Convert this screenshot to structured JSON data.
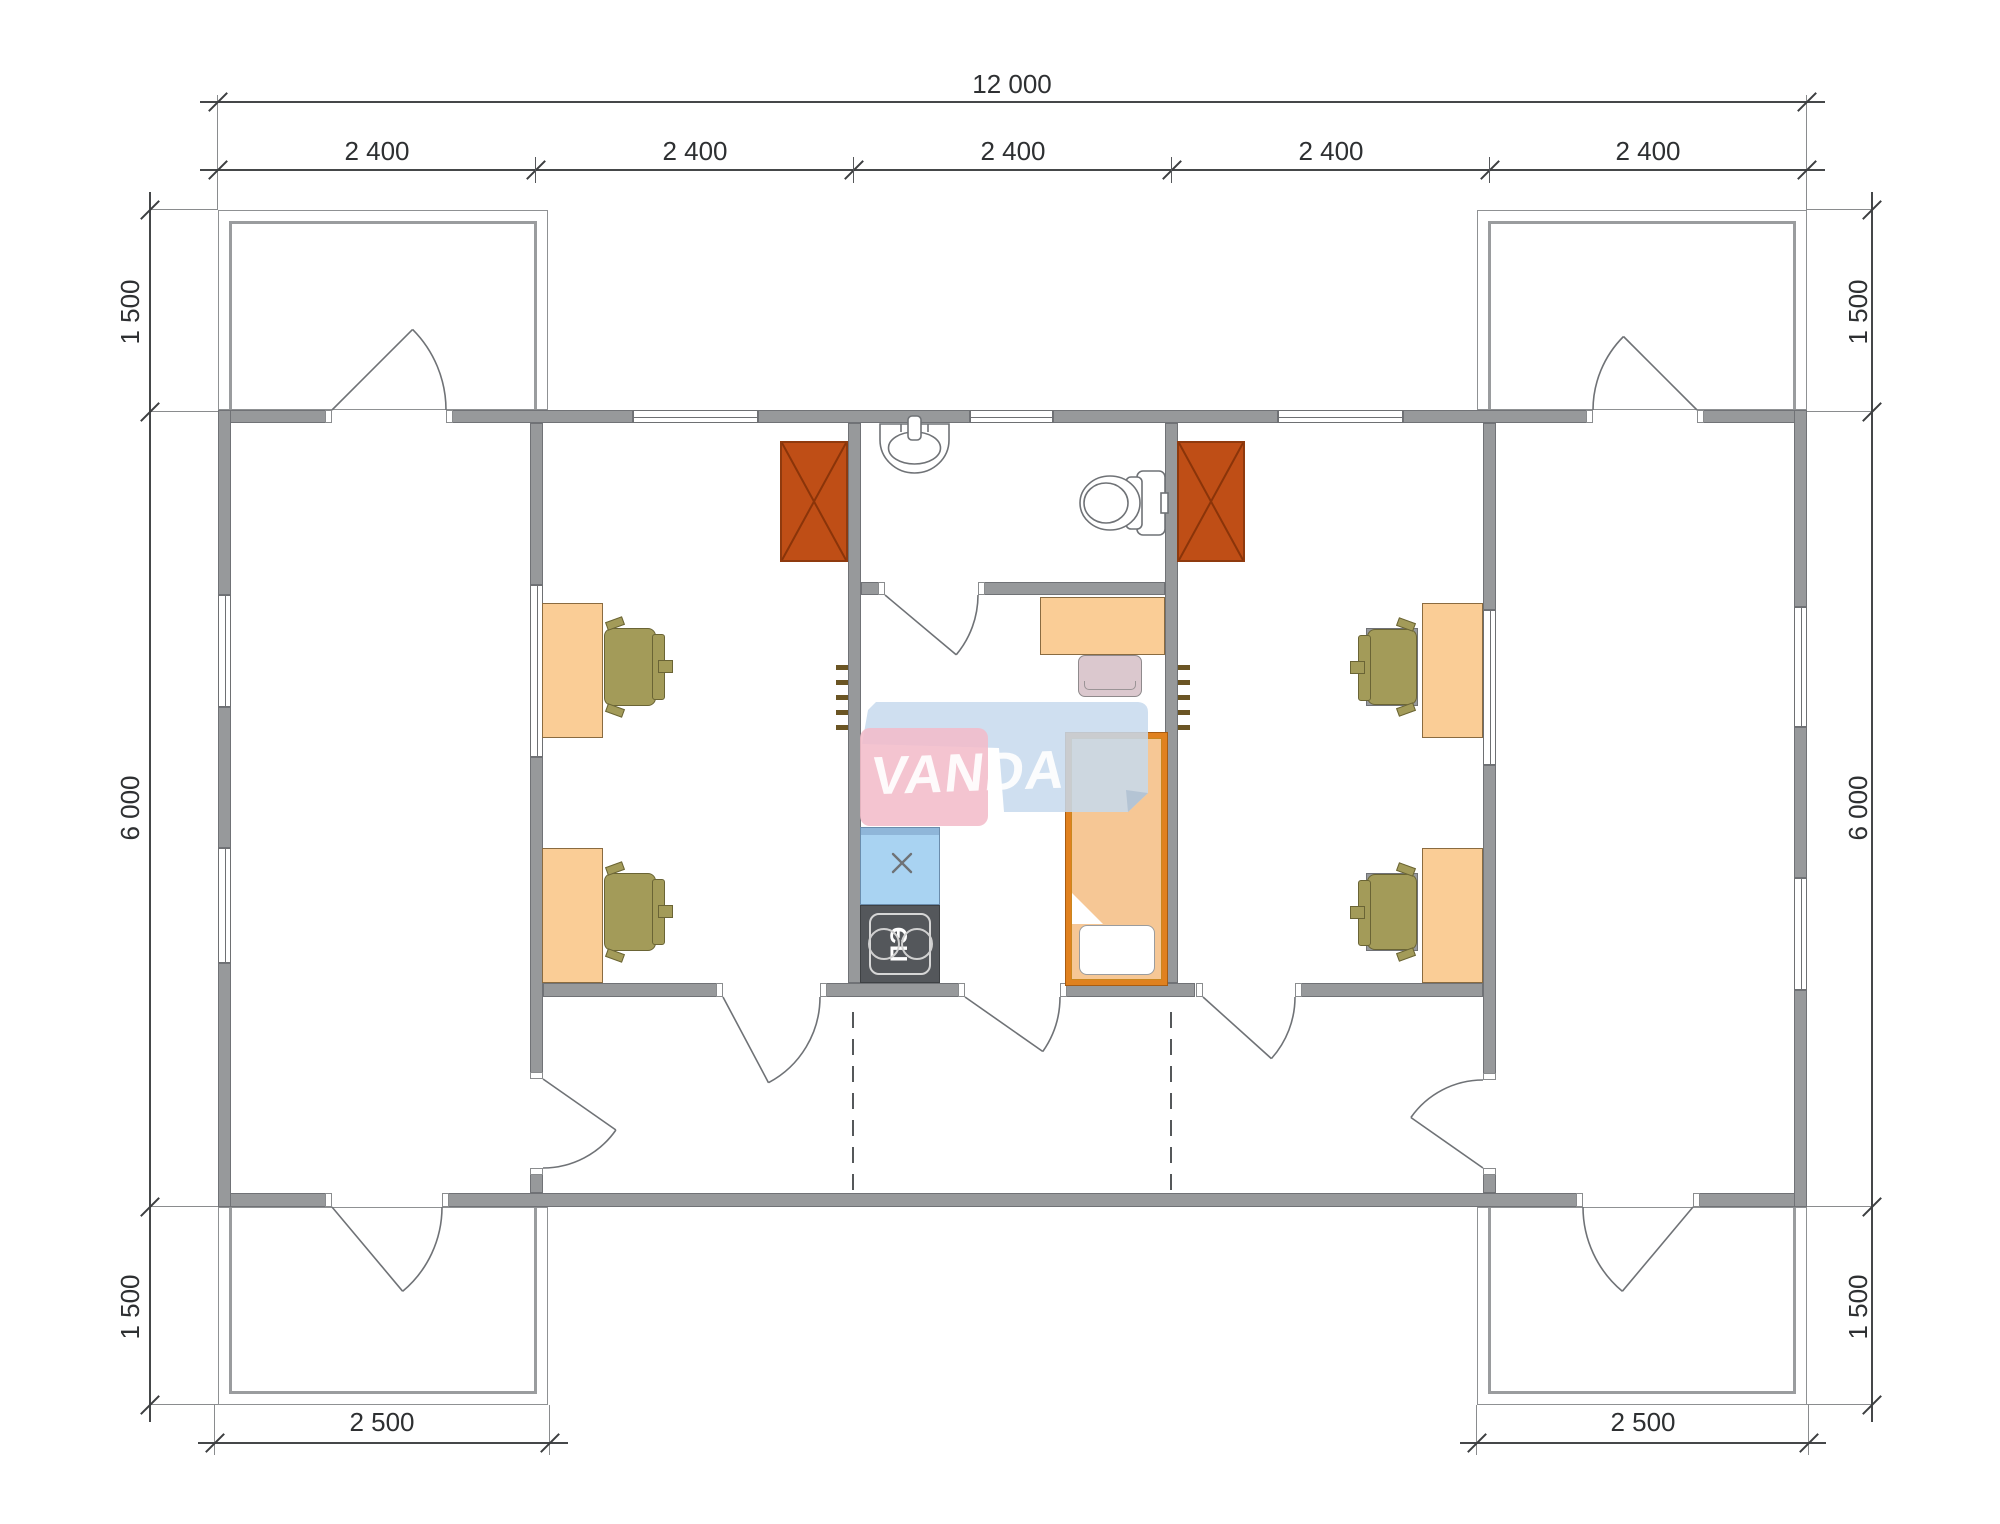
{
  "watermark": {
    "brand": "VANDA"
  },
  "dimensions": {
    "total_width": "12 000",
    "bays": [
      "2 400",
      "2 400",
      "2 400",
      "2 400",
      "2 400"
    ],
    "left_top": "1 500",
    "left_middle": "6 000",
    "left_bottom": "1 500",
    "right_top": "1 500",
    "right_middle": "6 000",
    "right_bottom": "1 500",
    "porch_left": "2 500",
    "porch_right": "2 500"
  },
  "kitchen": {
    "stove_label": "ПЭ"
  },
  "colors": {
    "wall": "#97999b",
    "stove_wood": "#bf4e16",
    "desk": "#facd96",
    "chair": "#a39b59",
    "bed_frame": "#e0811f",
    "mattress": "#f6c795",
    "counter": "#a9d3f2",
    "stove_electric": "#54575b",
    "wm_pink": "#f3bcc9",
    "wm_blue": "#c7daee",
    "dim_text": "#2e3032"
  }
}
